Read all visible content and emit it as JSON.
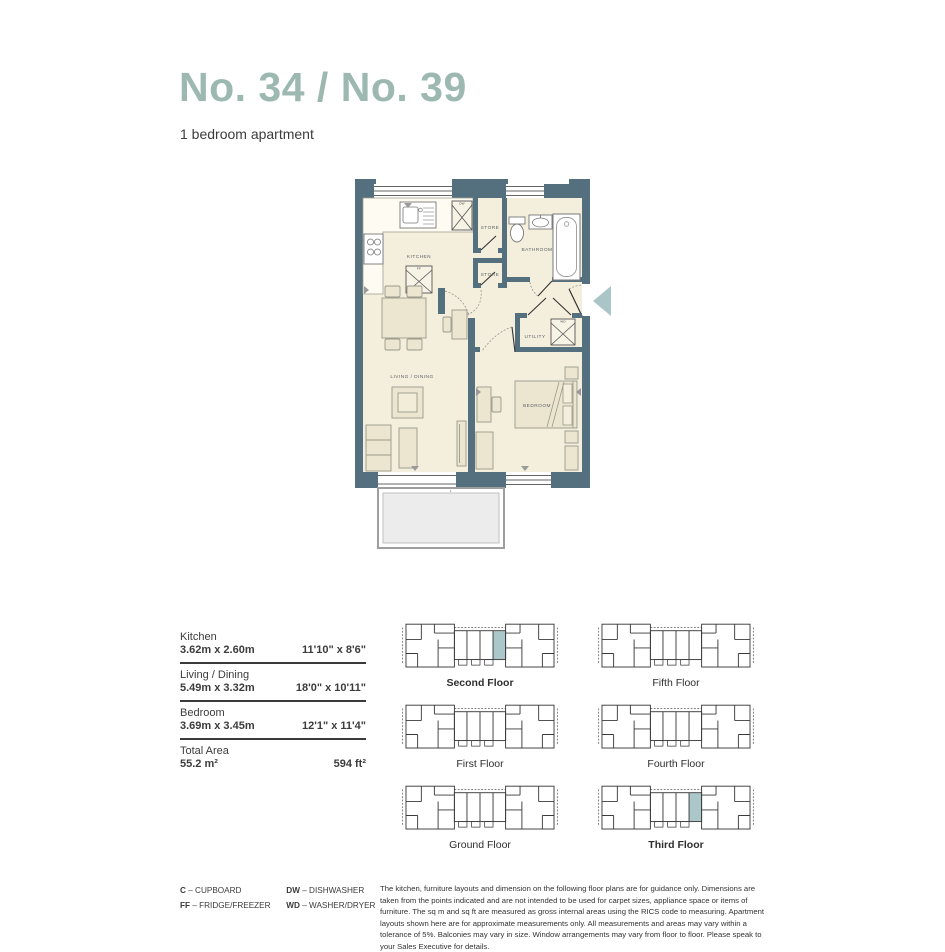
{
  "header": {
    "title": "No. 34 / No. 39",
    "subtitle": "1 bedroom apartment"
  },
  "colors": {
    "title_accent": "#9db8b1",
    "wall": "#54707f",
    "floor": "#f4efdd",
    "entry_arrow": "#a9c5c8",
    "locator_highlight": "#abc7c9"
  },
  "floorplan": {
    "labels": {
      "kitchen": "KITCHEN",
      "store_upper": "STORE",
      "store_lower": "STORE",
      "bathroom": "BATHROOM",
      "utility": "UTILITY",
      "living": "LIVING / DINING",
      "bedroom": "BEDROOM"
    },
    "appliance_tags": {
      "dw": "DW",
      "ff": "FF",
      "wd": "WD"
    }
  },
  "table": {
    "rows": [
      {
        "name": "Kitchen",
        "metric": "3.62m x 2.60m",
        "imperial": "11'10\" x 8'6\""
      },
      {
        "name": "Living / Dining",
        "metric": "5.49m x 3.32m",
        "imperial": "18'0\" x 10'11\""
      },
      {
        "name": "Bedroom",
        "metric": "3.69m x 3.45m",
        "imperial": "12'1\" x 11'4\""
      },
      {
        "name": "Total Area",
        "metric": "55.2 m²",
        "imperial": "594 ft²"
      }
    ]
  },
  "locator": {
    "floors": [
      {
        "label": "Second Floor",
        "highlighted": true
      },
      {
        "label": "Fifth Floor",
        "highlighted": false
      },
      {
        "label": "First Floor",
        "highlighted": false
      },
      {
        "label": "Fourth Floor",
        "highlighted": false
      },
      {
        "label": "Ground Floor",
        "highlighted": false
      },
      {
        "label": "Third Floor",
        "highlighted": true
      }
    ]
  },
  "legend": {
    "separator": "–",
    "items": [
      {
        "abbr": "C",
        "label": "CUPBOARD"
      },
      {
        "abbr": "FF",
        "label": "FRIDGE/FREEZER"
      },
      {
        "abbr": "DW",
        "label": "DISHWASHER"
      },
      {
        "abbr": "WD",
        "label": "WASHER/DRYER"
      }
    ]
  },
  "disclaimer": "The kitchen, furniture layouts and dimension on the following floor plans are for guidance only. Dimensions are taken from the points indicated and are not intended to be used for carpet sizes, appliance space or items of furniture.  The sq m and sq ft are measured as gross internal areas using the RICS code to measuring. Apartment layouts shown here are for approximate measurements only.  All measurements and areas may vary within a tolerance of 5%. Balconies may vary in size. Window arrangements may vary from floor to floor.  Please speak to your Sales Executive for details."
}
